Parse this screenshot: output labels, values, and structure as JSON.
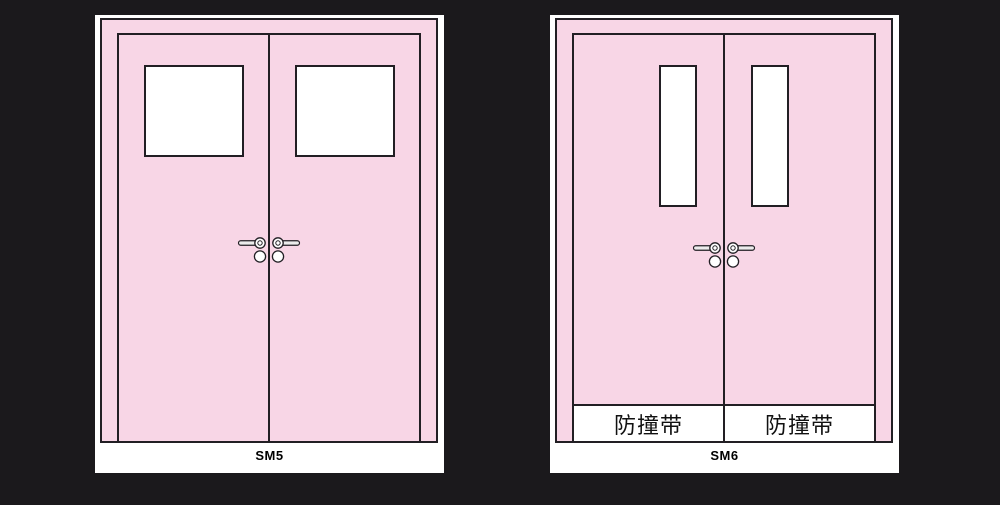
{
  "figures": [
    {
      "id": "sm5",
      "caption": "SM5",
      "window_style": "square-vision-panel"
    },
    {
      "id": "sm6",
      "caption": "SM6",
      "window_style": "narrow-vertical-vision-panel",
      "leaves": [
        {
          "strip_label": "防撞带"
        },
        {
          "strip_label": "防撞带"
        }
      ]
    }
  ],
  "icons": {
    "handle": "lever-handle-icon",
    "lock": "lock-cylinder-icon"
  },
  "colors": {
    "bg": "#1b191c",
    "panel": "#ffffff",
    "door-pink": "#f8d6e6",
    "line": "#221f24",
    "handle-fill": "#ececec",
    "text": "#111111"
  }
}
